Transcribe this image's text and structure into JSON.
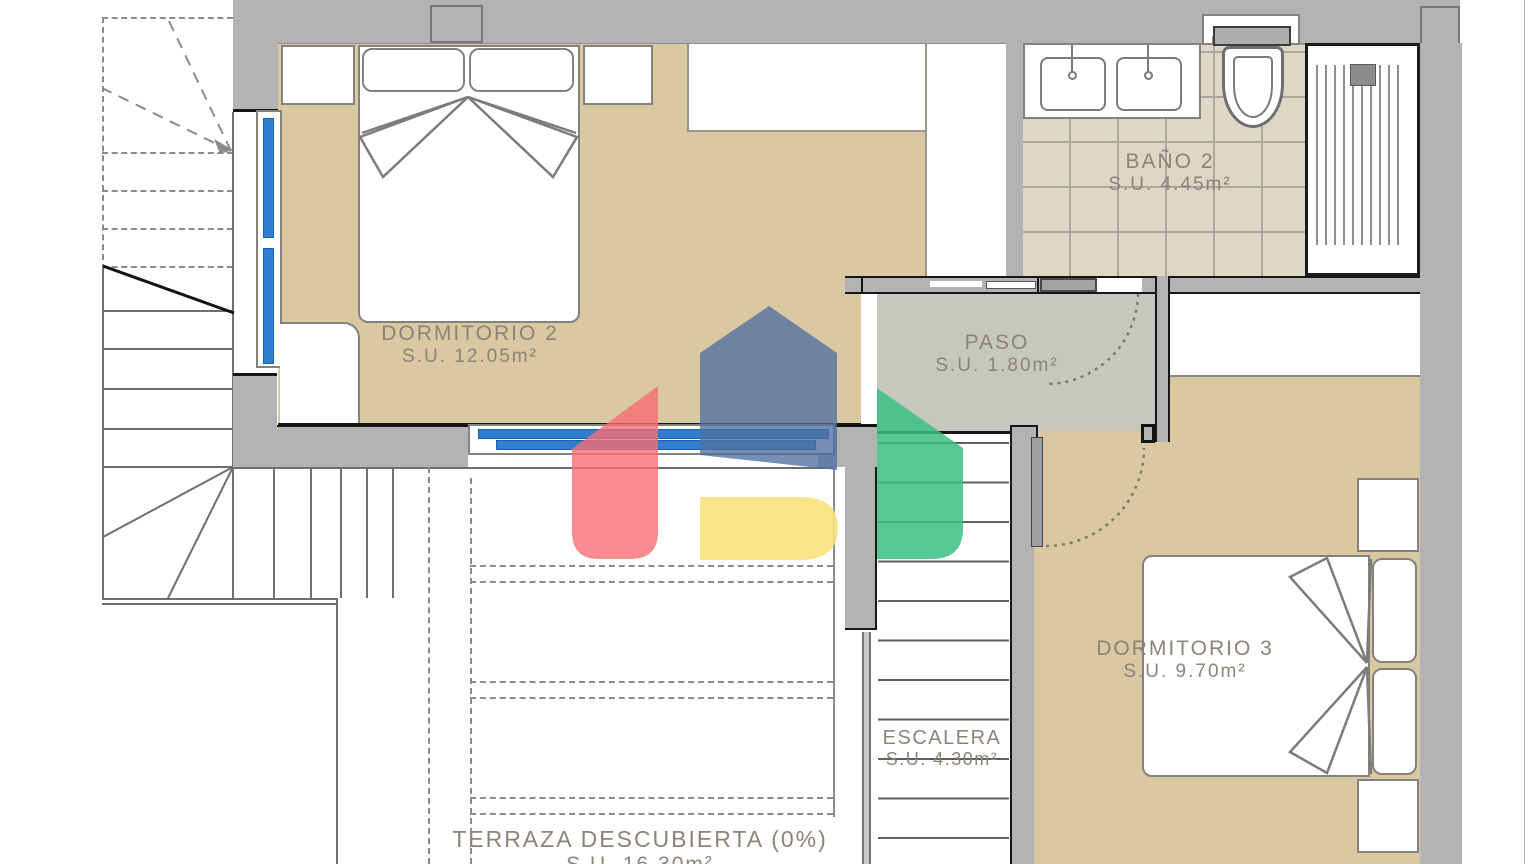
{
  "plan": {
    "title": "Planta alta - plano de vivienda",
    "rooms": [
      {
        "id": "dormitorio2",
        "name": "DORMITORIO 2",
        "area": "S.U. 12.05m²"
      },
      {
        "id": "bano2",
        "name": "BAÑO 2",
        "area": "S.U. 4.45m²"
      },
      {
        "id": "paso",
        "name": "PASO",
        "area": "S.U. 1.80m²"
      },
      {
        "id": "dormitorio3",
        "name": "DORMITORIO 3",
        "area": "S.U. 9.70m²"
      },
      {
        "id": "escalera",
        "name": "ESCALERA",
        "area": "S.U. 4.30m²"
      },
      {
        "id": "terraza",
        "name": "TERRAZA DESCUBIERTA (0%)",
        "area": "S.U. 16.30m²"
      }
    ],
    "colors": {
      "floor_tan": "#d9c8a1",
      "floor_tile": "#ded7c5",
      "tile_grid": "#aaa89c",
      "floor_paso": "#c6c8bf",
      "wall_gray": "#b3b3b5",
      "outline_black": "#161616",
      "furniture_stroke": "#82827f",
      "label_text": "#8c8379",
      "window_blue": "#2e7fd2"
    },
    "watermark": {
      "red": "rgba(246,110,115,0.8)",
      "blue": "rgba(80,112,160,0.78)",
      "green": "rgba(58,192,129,0.85)",
      "yellow": "rgba(249,225,125,0.9)"
    },
    "fixtures": [
      "double-bed",
      "pillows",
      "nightstands",
      "double-sink",
      "toilet",
      "shower",
      "stairs",
      "sliding-door",
      "swing-doors",
      "windows"
    ]
  }
}
